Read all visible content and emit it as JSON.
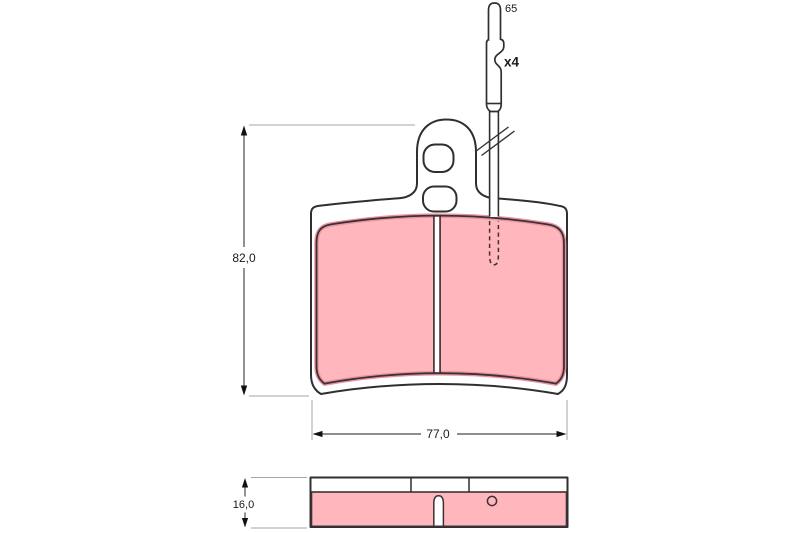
{
  "drawing": {
    "type": "brake-pad-technical-drawing",
    "labels": {
      "pad_height_mm": "82,0",
      "pad_width_mm": "77,0",
      "pad_thickness_mm": "16,0",
      "pin_length_mm": "65",
      "pin_quantity": "x4"
    },
    "colors": {
      "friction_material": "#ffb6bc",
      "friction_edge_shade": "#e8949e",
      "friction_outline": "#3b3136",
      "plate_outline": "#2f2f2f",
      "dimension_line": "#4a4a4a",
      "extension_line": "#a6a6a6",
      "background": "#ffffff"
    }
  }
}
